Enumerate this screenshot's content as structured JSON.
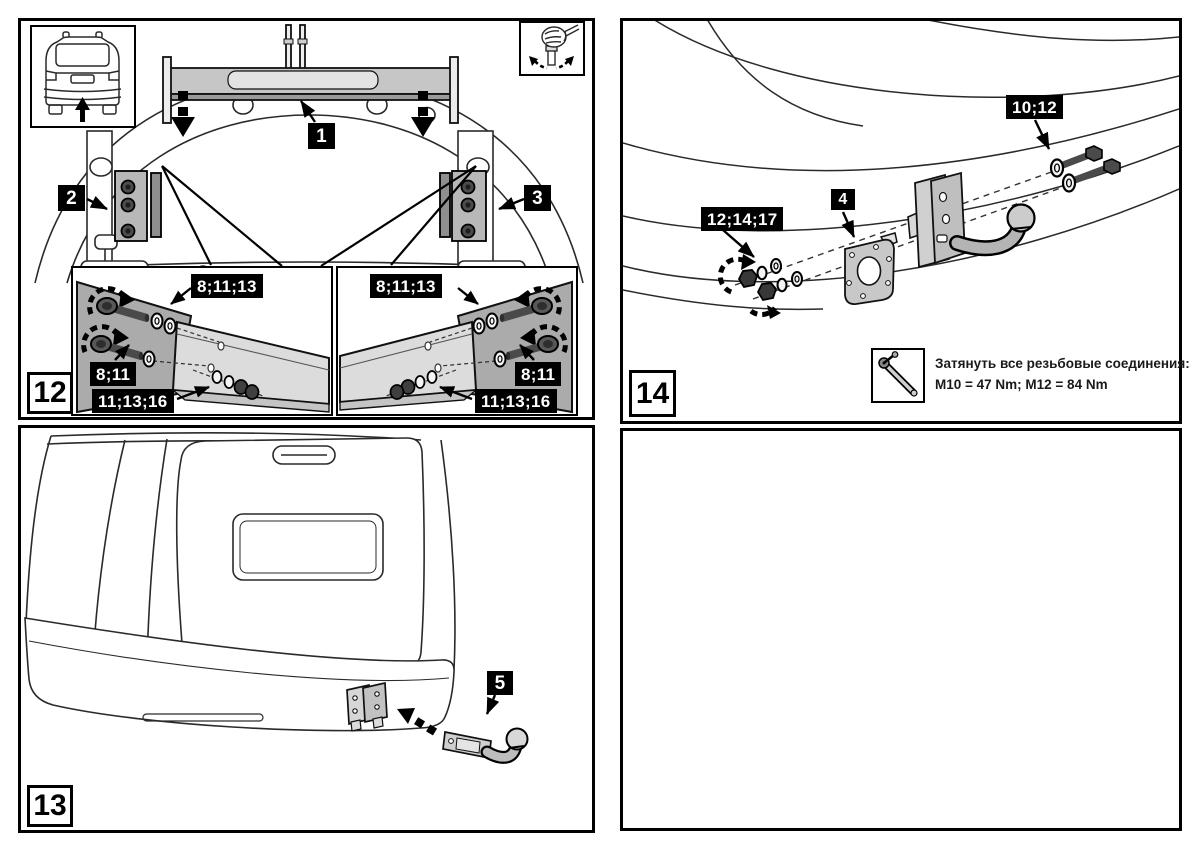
{
  "document": {
    "type": "towbar-installation-instruction-sheet",
    "language": "ru"
  },
  "colors": {
    "line": "#222222",
    "badge_bg": "#000000",
    "badge_text": "#ffffff",
    "panel_border": "#000000",
    "metal_light": "#dcdcdc",
    "metal_mid": "#b5b5b5",
    "metal_dark": "#585858"
  },
  "icons": {
    "rear_view_inset": "car-rear-view-with-up-arrow",
    "hand_tighten": "hand-tighten-bolt",
    "torque_wrench": "torque-wrench"
  },
  "step12": {
    "step_number": "12",
    "callouts": {
      "crossbar": "1",
      "left_bracket": "2",
      "right_bracket": "3"
    },
    "detail_left": {
      "bolts_top": "8;11;13",
      "bolt_side": "8;11",
      "nuts_bottom": "11;13;16"
    },
    "detail_right": {
      "bolts_top": "8;11;13",
      "bolt_side": "8;11",
      "nuts_bottom": "11;13;16"
    }
  },
  "step13": {
    "step_number": "13",
    "callouts": {
      "ball_arm": "5"
    }
  },
  "step14": {
    "step_number": "14",
    "callouts": {
      "bolts": "10;12",
      "socket_plate": "4",
      "nuts": "12;14;17"
    },
    "torque_note": {
      "line1": "Затянуть все резьбовые соединения:",
      "line2": "M10 = 47 Nm;  M12 = 84 Nm"
    }
  }
}
